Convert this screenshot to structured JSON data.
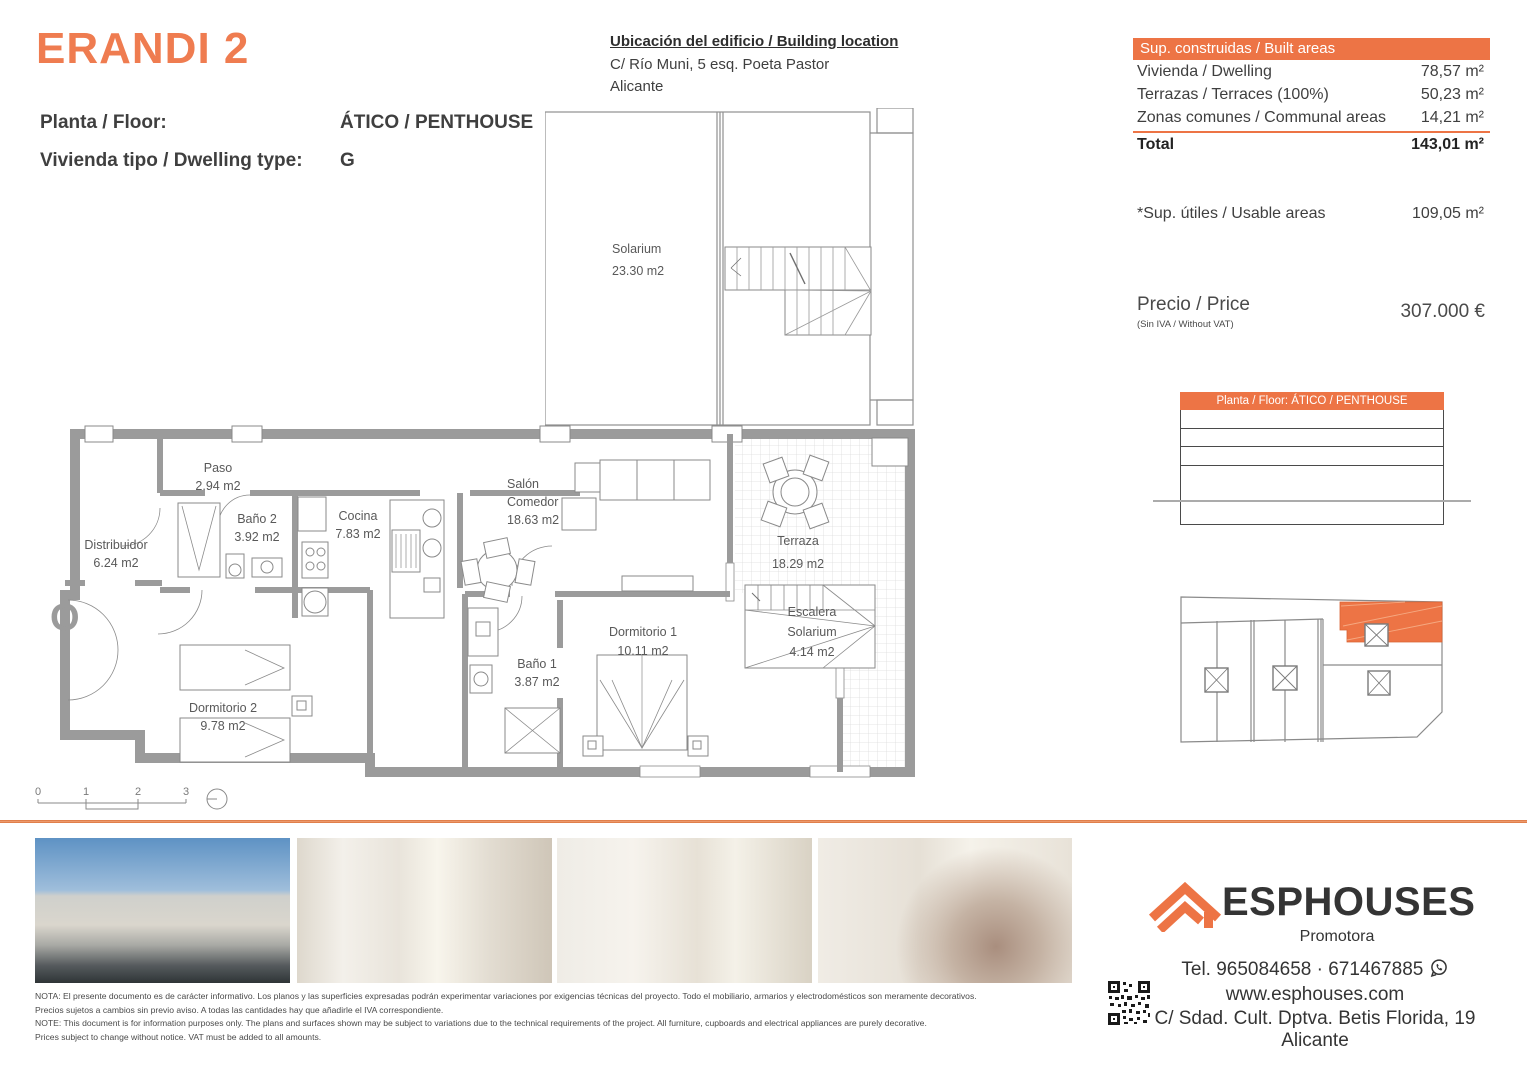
{
  "colors": {
    "accent_orange": "#ed7445",
    "title_orange": "#ef7c50",
    "divider_orange": "#d96e35",
    "wall_gray": "#9b9b9b",
    "plan_line_gray": "#8a8a8a",
    "text_dark": "#3f3f3f",
    "highlight_unit": "#ed7445"
  },
  "header": {
    "title": "ERANDI 2",
    "floor_label": "Planta / Floor:",
    "floor_value": "ÁTICO / PENTHOUSE",
    "type_label": "Vivienda tipo / Dwelling type:",
    "type_value": "G"
  },
  "location": {
    "heading": "Ubicación del edificio / Building location",
    "address_line1": "C/ Río Muni, 5 esq. Poeta Pastor",
    "address_line2": "Alicante"
  },
  "built_areas": {
    "header": "Sup. construidas / Built areas",
    "rows": [
      {
        "label": "Vivienda / Dwelling",
        "value": "78,57 m²"
      },
      {
        "label": "Terrazas / Terraces (100%)",
        "value": "50,23 m²"
      },
      {
        "label": "Zonas comunes / Communal areas",
        "value": "14,21 m²"
      }
    ],
    "total_label": "Total",
    "total_value": "143,01 m²"
  },
  "usable_areas": {
    "label": "*Sup. útiles / Usable areas",
    "value": "109,05 m²"
  },
  "price": {
    "label": "Precio / Price",
    "sublabel": "(Sin IVA / Without VAT)",
    "value": "307.000 €"
  },
  "side_key": {
    "header": "Planta / Floor: ÁTICO / PENTHOUSE"
  },
  "plan": {
    "orientation_letter": "O",
    "scale_ticks": [
      "0",
      "1",
      "2",
      "3"
    ],
    "rooms": {
      "solarium": {
        "name": "Solarium",
        "area": "23.30 m2"
      },
      "paso": {
        "name": "Paso",
        "area": "2.94 m2"
      },
      "bano2": {
        "name": "Baño 2",
        "area": "3.92 m2"
      },
      "cocina": {
        "name": "Cocina",
        "area": "7.83 m2"
      },
      "distribuidor": {
        "name": "Distribuidor",
        "area": "6.24 m2"
      },
      "dormitorio2": {
        "name": "Dormitorio 2",
        "area": "9.78 m2"
      },
      "salon": {
        "name1": "Salón",
        "name2": "Comedor",
        "area": "18.63 m2"
      },
      "terraza": {
        "name": "Terraza",
        "area": "18.29 m2"
      },
      "dormitorio1": {
        "name": "Dormitorio 1",
        "area": "10.11 m2"
      },
      "bano1": {
        "name": "Baño 1",
        "area": "3.87 m2"
      },
      "escalera": {
        "name1": "Escalera",
        "name2": "Solarium",
        "area": "4.14 m2"
      }
    }
  },
  "footer": {
    "disclaimer": [
      "NOTA: El presente documento es de carácter informativo. Los planos y las superficies expresadas podrán experimentar variaciones por exigencias técnicas del proyecto. Todo el mobiliario, armarios y electrodomésticos son meramente decorativos.",
      "Precios sujetos a cambios sin previo aviso. A todas las cantidades hay que añadirle el IVA correspondiente.",
      "NOTE: This document is for information purposes only. The plans and surfaces shown may be subject to variations due to the technical requirements of the project. All furniture, cupboards and electrical appliances are purely decorative.",
      "Prices subject to change without notice. VAT must be added to all amounts."
    ],
    "brand": {
      "name": "ESPHOUSES",
      "tagline": "Promotora",
      "tel": "Tel. 965084658 · 671467885",
      "web": "www.esphouses.com",
      "address": "C/ Sdad. Cult. Dptva. Betis Florida, 19",
      "city": "Alicante"
    }
  }
}
